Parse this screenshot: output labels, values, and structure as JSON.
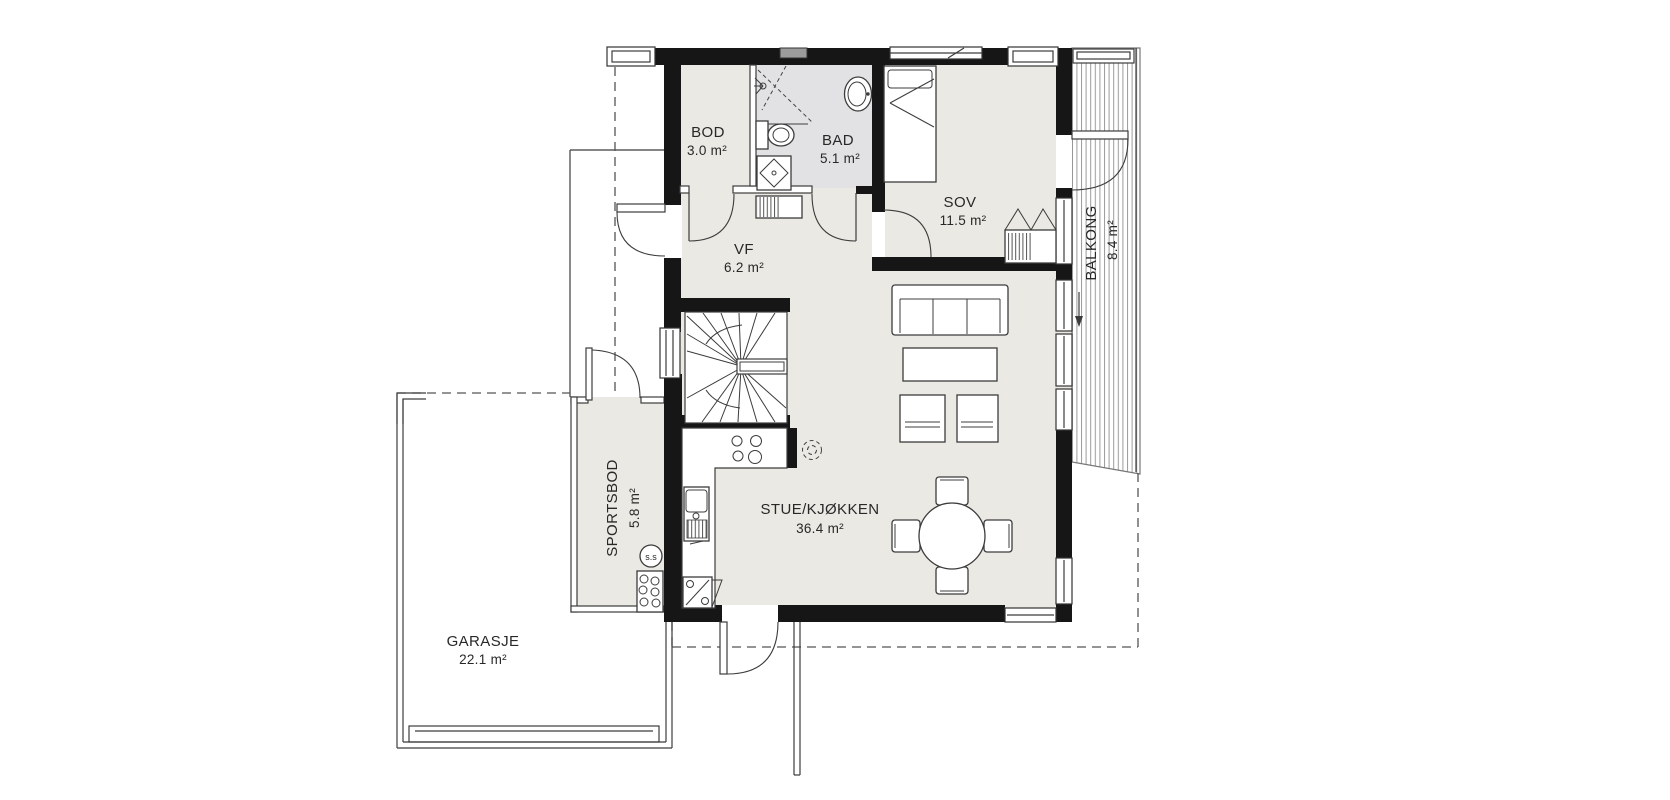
{
  "plan": {
    "rooms": {
      "bod": {
        "name": "BOD",
        "area": "3.0 m²"
      },
      "bad": {
        "name": "BAD",
        "area": "5.1 m²"
      },
      "sov": {
        "name": "SOV",
        "area": "11.5 m²"
      },
      "vf": {
        "name": "VF",
        "area": "6.2 m²"
      },
      "stue_kjokken": {
        "name": "STUE/KJØKKEN",
        "area": "36.4 m²"
      },
      "sportsbod": {
        "name": "SPORTSBOD",
        "area": "5.8 m²"
      },
      "balkong": {
        "name": "BALKONG",
        "area": "8.4 m²"
      },
      "garasje": {
        "name": "GARASJE",
        "area": "22.1 m²"
      }
    },
    "symbols": {
      "water_heater": "s.s"
    },
    "colors": {
      "floor": "#ebe9e3",
      "bathroom_floor": "#e2e2e4",
      "wall": "#161616",
      "line": "#3c3c3c",
      "vent": "#9c9c9c"
    }
  }
}
